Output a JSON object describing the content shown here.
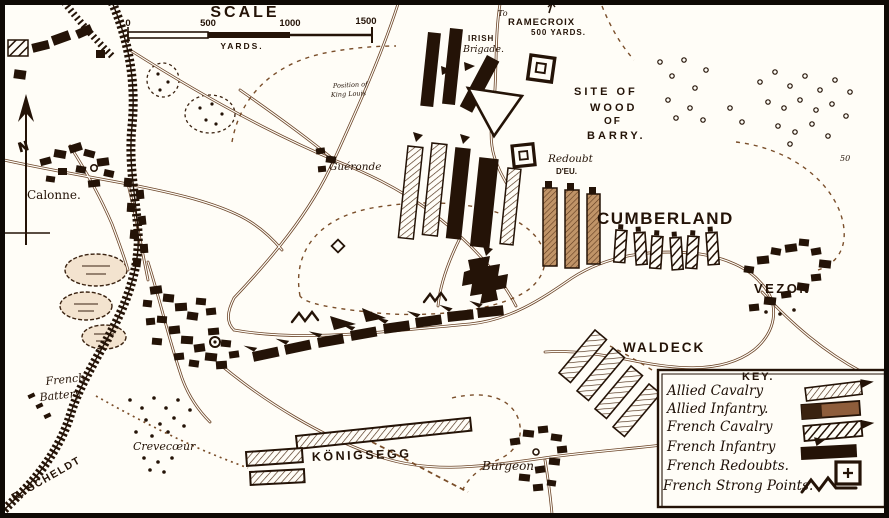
{
  "map": {
    "scale": {
      "title": "SCALE",
      "ticks": [
        "0",
        "500",
        "1000",
        "1500"
      ],
      "units": "YARDS."
    },
    "labels": {
      "to": "To",
      "ramecroix": "RAMECROIX",
      "ramecroix_dist": "500 YARDS.",
      "irish_line1": "IRISH",
      "irish_line2": "Brigade.",
      "site_line1": "SITE OF",
      "site_line2": "WOOD",
      "site_line3": "OF",
      "site_line4": "BARRY.",
      "redoubt_line1": "Redoubt",
      "redoubt_line2": "D'EU.",
      "cumberland": "CUMBERLAND",
      "vezon": "VEZON",
      "waldeck": "WALDECK",
      "konigsegg": "KÖNIGSEGG",
      "burgeon": "Burgeon",
      "crevecoeur": "Crevecœur",
      "battery_line1": "French",
      "battery_line2": "Battery",
      "scheldt": "R. SCHELDT",
      "calonne": "Calonne.",
      "gueronde": "Guéronde",
      "king_line1": "Position of",
      "king_line2": "King Louis",
      "north": "N",
      "contour_50": "50"
    },
    "key": {
      "title": "KEY.",
      "items": [
        {
          "label": "Allied Cavalry",
          "symbol": "allied-cavalry-bar"
        },
        {
          "label": "Allied Infantry.",
          "symbol": "allied-infantry-bar"
        },
        {
          "label": "French Cavalry",
          "symbol": "french-cavalry-bar"
        },
        {
          "label": "French Infantry",
          "symbol": "french-infantry-bar"
        },
        {
          "label": "French Redoubts.",
          "symbol": "french-redoubt-square"
        },
        {
          "label": "French Strong Points.",
          "symbol": "french-strong-point-zigzag"
        }
      ]
    },
    "colors": {
      "ink": "#241307",
      "road": "#6b4428",
      "dash": "#7a4e2a",
      "paper": "#fffdf7",
      "mid_sepia": "#8e5d3b"
    }
  }
}
